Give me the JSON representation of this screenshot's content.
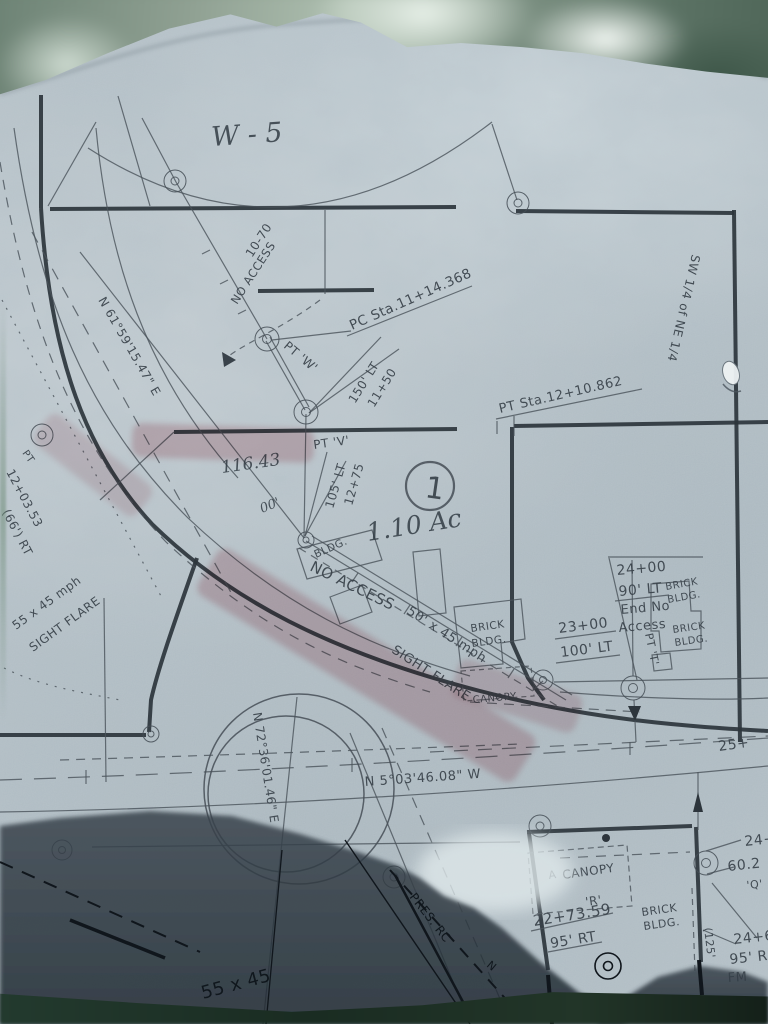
{
  "document_kind": "highway right-of-way survey plat (photographed on translucent vellum)",
  "colors": {
    "paper": "#b6c1c7",
    "ink": "#39424a",
    "heavy_ink": "#2d353c",
    "highlighter": "#c36c78",
    "shadow": "#27313a",
    "foliage": "#6d8274"
  },
  "parcel": {
    "number": "1",
    "area_handwritten": "1.10 Ac"
  },
  "labels": {
    "w5": "W - 5",
    "sta1070": "10-70",
    "no_access_top": "NO ACCESS",
    "pc_sta": "PC Sta.11+14.368",
    "pt_w": "PT 'W'",
    "sta1150": "11+50",
    "off150": "150' LT",
    "pt_v": "PT 'V'",
    "sta1275": "12+75",
    "off105": "105' LT",
    "parcel_num": "1",
    "area_note": "1.10 Ac",
    "hand116": "116.43",
    "hand00": "00'",
    "bearing_ramp": "N 61°59'15.47\" E",
    "sta120353": "12+03.53",
    "off66": "(66') RT",
    "pt_left": "PT",
    "flare5545": "55 x 45 mph",
    "sight_flare_left": "SIGHT FLARE",
    "bldg_small": "BLDG.",
    "no_access_main": "NO ACCESS",
    "flare5045": "50' x 45 mph",
    "sight_flare_main": "SIGHT FLARE",
    "brick1_l1": "BRICK",
    "brick1_l2": "BLDG.",
    "canopy_mid": "CANOPY",
    "sta2300": "23+00",
    "off100": "100' LT",
    "sta2400": "24+00",
    "off90": "90' LT",
    "end_no": "End No",
    "access_word": "Access",
    "brick2_l1": "BRICK",
    "brick2_l2": "BLDG.",
    "brick3_l1": "BRICK",
    "brick3_l2": "BLDG.",
    "pt_t": "PT 'T'",
    "sw_quarter": "SW 1/4 of NE 1/4",
    "pt_sta12": "PT Sta.12+10.862",
    "sta25": "25+",
    "bearing_road": "N 5°03'46.08\" W",
    "bearing_vert": "N 72°36'01.46\" E",
    "a_mark": "A",
    "canopy_r_l1": "CANOPY",
    "canopy_r_l2": "'R'",
    "sta2273": "22+73.59",
    "off95rt": "95' RT",
    "brick4_l1": "BRICK",
    "brick4_l2": "BLDG.",
    "dim125": "(125'",
    "r24": "24+",
    "r602": "60.2",
    "rq": "'Q'",
    "r246": "24+6",
    "r95r": "95' R",
    "rfm": "FM",
    "pres_rc": "PRES. RC",
    "n_label": "N",
    "hand5545": "55 x 45"
  }
}
